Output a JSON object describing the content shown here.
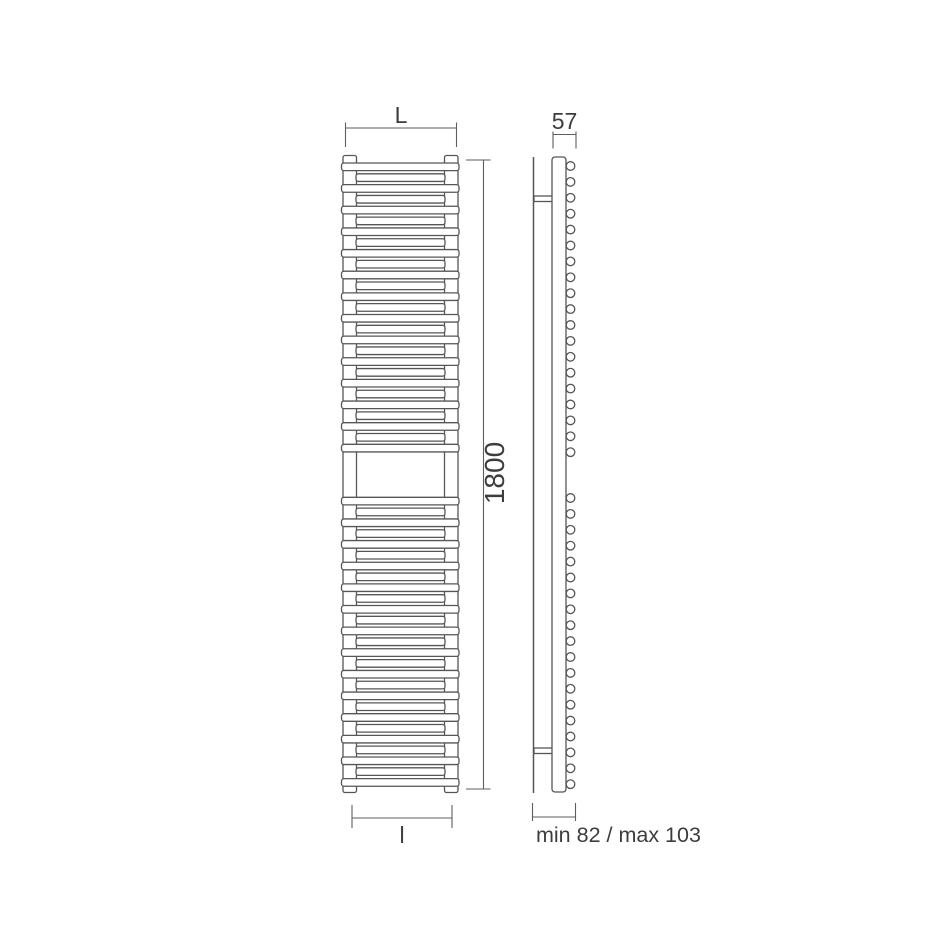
{
  "colors": {
    "bg": "#ffffff",
    "line": "#565656",
    "dim": "#5e5e5e",
    "text": "#3d3d3d"
  },
  "dimensions": {
    "width_label": "L",
    "height_label": "1800",
    "axle_distance_label": "l",
    "depth_label": "57",
    "wall_distance_label": "min 82 / max 103"
  },
  "front_view": {
    "tube_count_top": 27,
    "tube_count_bottom": 27
  },
  "side_view": {
    "tube_end_count_top": 19,
    "tube_end_count_bottom": 19
  }
}
